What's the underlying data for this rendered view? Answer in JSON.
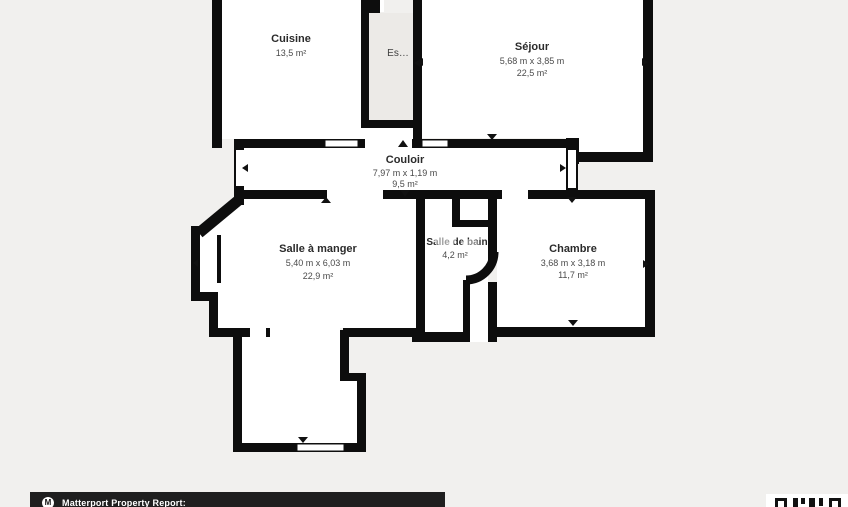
{
  "floorplan": {
    "rooms": {
      "cuisine": {
        "name": "Cuisine",
        "area": "13,5 m²"
      },
      "sejour": {
        "name": "Séjour",
        "dimensions": "5,68 m x 3,85 m",
        "area": "22,5 m²"
      },
      "couloir": {
        "name": "Couloir",
        "dimensions": "7,97 m x 1,19 m",
        "area": "9,5 m²"
      },
      "salle_a_manger": {
        "name": "Salle à manger",
        "dimensions": "5,40 m x 6,03 m",
        "area": "22,9 m²"
      },
      "salle_de_bain": {
        "name": "Salle de bain",
        "area": "4,2 m²"
      },
      "chambre": {
        "name": "Chambre",
        "dimensions": "3,68 m x 3,18 m",
        "area": "11,7 m²"
      },
      "escalier": {
        "name": "Es…"
      }
    },
    "colors": {
      "background": "#f1f0ee",
      "wall": "#0d0d0d",
      "floor": "#ffffff",
      "shaft": "#eceae7"
    }
  },
  "footer": {
    "report_label": "Matterport Property Report:",
    "logo_glyph": "M"
  }
}
